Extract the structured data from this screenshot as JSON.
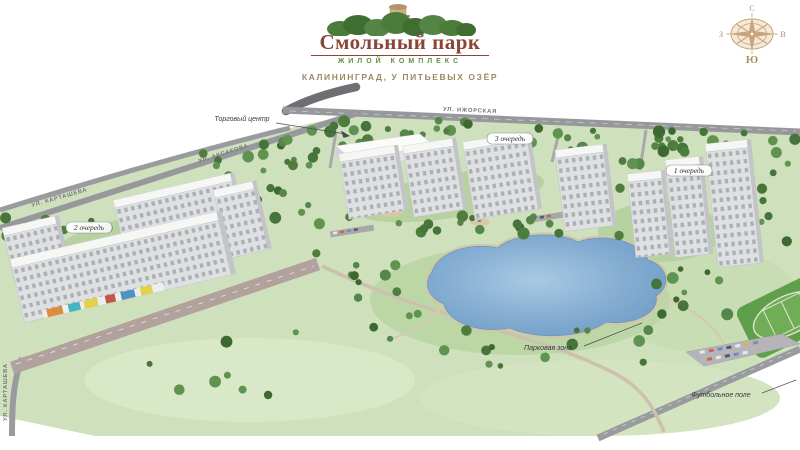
{
  "header": {
    "logo": {
      "title": "Смольный парк",
      "subtitle": "ЖИЛОЙ КОМПЛЕКС"
    },
    "tagline": "КАЛИНИНГРАД, У ПИТЬЕВЫХ ОЗЁР"
  },
  "compass": {
    "north": "С",
    "south": "Ю",
    "west": "З",
    "east": "В"
  },
  "map": {
    "streets": {
      "izhorskaya": "УЛ. ИЖОРСКАЯ",
      "aksakova": "УЛ. АКСАКОВА",
      "kartasheva": "УЛ. КАРТАШЕВА",
      "kartasheva_side": "УЛ. КАРТАШЕВА"
    },
    "callouts": {
      "shopping_center": "Торговый центр",
      "park_zone": "Парковая зона",
      "football_field": "Футбольное поле"
    },
    "phases": [
      {
        "label": "2 очередь"
      },
      {
        "label": "3 очередь"
      },
      {
        "label": "1 очередь"
      }
    ]
  },
  "colors": {
    "logo_title": "#8a4538",
    "logo_subtitle": "#5d8f3f",
    "tagline": "#9d8766",
    "compass": "#b08d5e",
    "land": "#cfe0bd",
    "tree": "#46743a",
    "lake": "#84add2",
    "road": "#97989c",
    "boulevard": "#b2a29e",
    "building_facade": "#dfe0e2",
    "football_field": "#5f9e4b"
  }
}
